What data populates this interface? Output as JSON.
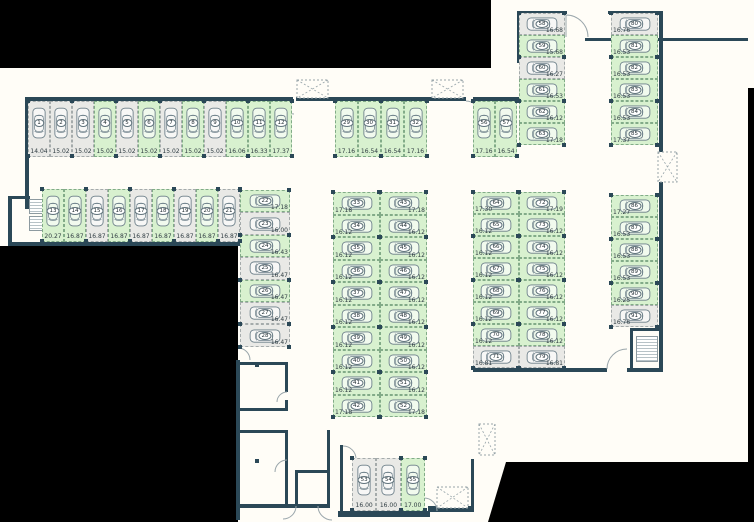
{
  "colors": {
    "wall": "#2b4857",
    "space_green": "#d8f1cf",
    "space_gray": "#e9e9e6",
    "outside": "#000000",
    "car_outline": "#6b7e88"
  },
  "groups": [
    {
      "id": "row-1",
      "spaces": [
        {
          "n": "1",
          "m": "14.04",
          "c": "gray"
        },
        {
          "n": "2",
          "m": "15.02",
          "c": "gray"
        },
        {
          "n": "3",
          "m": "15.02",
          "c": "gray"
        },
        {
          "n": "4",
          "m": "15.02",
          "c": "green"
        },
        {
          "n": "5",
          "m": "15.02",
          "c": "gray"
        },
        {
          "n": "6",
          "m": "15.02",
          "c": "green"
        },
        {
          "n": "7",
          "m": "15.02",
          "c": "gray"
        },
        {
          "n": "8",
          "m": "15.02",
          "c": "green"
        },
        {
          "n": "9",
          "m": "15.02",
          "c": "gray"
        },
        {
          "n": "10",
          "m": "16.06",
          "c": "green"
        },
        {
          "n": "11",
          "m": "16.33",
          "c": "green"
        },
        {
          "n": "12",
          "m": "17.37",
          "c": "green"
        }
      ]
    },
    {
      "id": "row-2",
      "spaces": [
        {
          "n": "13",
          "m": "20.27",
          "c": "green"
        },
        {
          "n": "14",
          "m": "16.87",
          "c": "green"
        },
        {
          "n": "15",
          "m": "16.87",
          "c": "gray"
        },
        {
          "n": "16",
          "m": "16.87",
          "c": "green"
        },
        {
          "n": "17",
          "m": "16.87",
          "c": "gray"
        },
        {
          "n": "18",
          "m": "16.87",
          "c": "green"
        },
        {
          "n": "19",
          "m": "16.87",
          "c": "gray"
        },
        {
          "n": "20",
          "m": "16.87",
          "c": "green"
        },
        {
          "n": "21",
          "m": "16.87",
          "c": "gray"
        }
      ]
    },
    {
      "id": "col-22-28",
      "spaces": [
        {
          "n": "22",
          "m": "17.18",
          "c": "green"
        },
        {
          "n": "23",
          "m": "16.00",
          "c": "gray"
        },
        {
          "n": "24",
          "m": "16.43",
          "c": "green"
        },
        {
          "n": "25",
          "m": "16.47",
          "c": "gray"
        },
        {
          "n": "26",
          "m": "16.47",
          "c": "green"
        },
        {
          "n": "27",
          "m": "16.47",
          "c": "gray"
        },
        {
          "n": "28",
          "m": "16.47",
          "c": "gray"
        }
      ]
    },
    {
      "id": "row-29-32",
      "spaces": [
        {
          "n": "29",
          "m": "17.16",
          "c": "green"
        },
        {
          "n": "30",
          "m": "16.54",
          "c": "green"
        },
        {
          "n": "31",
          "m": "16.54",
          "c": "green"
        },
        {
          "n": "32",
          "m": "17.16",
          "c": "green"
        }
      ]
    },
    {
      "id": "blockA-left",
      "spaces": [
        {
          "n": "33",
          "m": "17.18",
          "c": "green"
        },
        {
          "n": "34",
          "m": "16.12",
          "c": "green"
        },
        {
          "n": "35",
          "m": "16.12",
          "c": "green"
        },
        {
          "n": "36",
          "m": "16.12",
          "c": "green"
        },
        {
          "n": "37",
          "m": "16.12",
          "c": "green"
        },
        {
          "n": "38",
          "m": "16.12",
          "c": "green"
        },
        {
          "n": "39",
          "m": "16.12",
          "c": "green"
        },
        {
          "n": "40",
          "m": "16.12",
          "c": "green"
        },
        {
          "n": "41",
          "m": "16.12",
          "c": "green"
        },
        {
          "n": "42",
          "m": "17.18",
          "c": "green"
        }
      ]
    },
    {
      "id": "blockA-right",
      "spaces": [
        {
          "n": "43",
          "m": "17.18",
          "c": "green"
        },
        {
          "n": "44",
          "m": "16.12",
          "c": "green"
        },
        {
          "n": "45",
          "m": "16.12",
          "c": "green"
        },
        {
          "n": "46",
          "m": "16.12",
          "c": "green"
        },
        {
          "n": "47",
          "m": "16.12",
          "c": "green"
        },
        {
          "n": "48",
          "m": "16.12",
          "c": "green"
        },
        {
          "n": "49",
          "m": "16.12",
          "c": "green"
        },
        {
          "n": "50",
          "m": "16.12",
          "c": "green"
        },
        {
          "n": "51",
          "m": "16.12",
          "c": "green"
        },
        {
          "n": "52",
          "m": "17.18",
          "c": "green"
        }
      ]
    },
    {
      "id": "row-56-57",
      "spaces": [
        {
          "n": "56",
          "m": "17.16",
          "c": "green"
        },
        {
          "n": "57",
          "m": "16.54",
          "c": "green"
        }
      ]
    },
    {
      "id": "col-58-63",
      "spaces": [
        {
          "n": "58",
          "m": "16.68",
          "c": "gray"
        },
        {
          "n": "59",
          "m": "15.68",
          "c": "green"
        },
        {
          "n": "60",
          "m": "16.27",
          "c": "gray"
        },
        {
          "n": "61",
          "m": "16.53",
          "c": "green"
        },
        {
          "n": "62",
          "m": "16.12",
          "c": "green"
        },
        {
          "n": "63",
          "m": "17.18",
          "c": "green"
        }
      ]
    },
    {
      "id": "col-80-85",
      "spaces": [
        {
          "n": "80",
          "m": "16.76",
          "c": "gray"
        },
        {
          "n": "81",
          "m": "16.53",
          "c": "green"
        },
        {
          "n": "82",
          "m": "16.53",
          "c": "green"
        },
        {
          "n": "83",
          "m": "16.53",
          "c": "green"
        },
        {
          "n": "84",
          "m": "16.53",
          "c": "green"
        },
        {
          "n": "85",
          "m": "17.37",
          "c": "green"
        }
      ]
    },
    {
      "id": "blockB-left",
      "spaces": [
        {
          "n": "64",
          "m": "17.30",
          "c": "green"
        },
        {
          "n": "65",
          "m": "16.12",
          "c": "green"
        },
        {
          "n": "66",
          "m": "16.12",
          "c": "green"
        },
        {
          "n": "67",
          "m": "16.12",
          "c": "green"
        },
        {
          "n": "68",
          "m": "16.12",
          "c": "green"
        },
        {
          "n": "69",
          "m": "16.12",
          "c": "green"
        },
        {
          "n": "70",
          "m": "16.12",
          "c": "green"
        },
        {
          "n": "71",
          "m": "16.81",
          "c": "gray"
        }
      ]
    },
    {
      "id": "blockB-right",
      "spaces": [
        {
          "n": "72",
          "m": "17.19",
          "c": "green"
        },
        {
          "n": "73",
          "m": "16.12",
          "c": "green"
        },
        {
          "n": "74",
          "m": "16.12",
          "c": "green"
        },
        {
          "n": "75",
          "m": "16.12",
          "c": "green"
        },
        {
          "n": "76",
          "m": "16.12",
          "c": "green"
        },
        {
          "n": "77",
          "m": "16.12",
          "c": "green"
        },
        {
          "n": "78",
          "m": "16.12",
          "c": "green"
        },
        {
          "n": "79",
          "m": "16.81",
          "c": "gray"
        }
      ]
    },
    {
      "id": "col-86-91",
      "spaces": [
        {
          "n": "86",
          "m": "17.27",
          "c": "green"
        },
        {
          "n": "87",
          "m": "16.53",
          "c": "green"
        },
        {
          "n": "88",
          "m": "16.53",
          "c": "green"
        },
        {
          "n": "89",
          "m": "16.53",
          "c": "green"
        },
        {
          "n": "90",
          "m": "16.25",
          "c": "green"
        },
        {
          "n": "91",
          "m": "16.76",
          "c": "gray"
        }
      ]
    },
    {
      "id": "row-53-55",
      "spaces": [
        {
          "n": "53",
          "m": "16.00",
          "c": "gray"
        },
        {
          "n": "54",
          "m": "16.00",
          "c": "gray"
        },
        {
          "n": "55",
          "m": "17.00",
          "c": "green"
        }
      ]
    }
  ]
}
